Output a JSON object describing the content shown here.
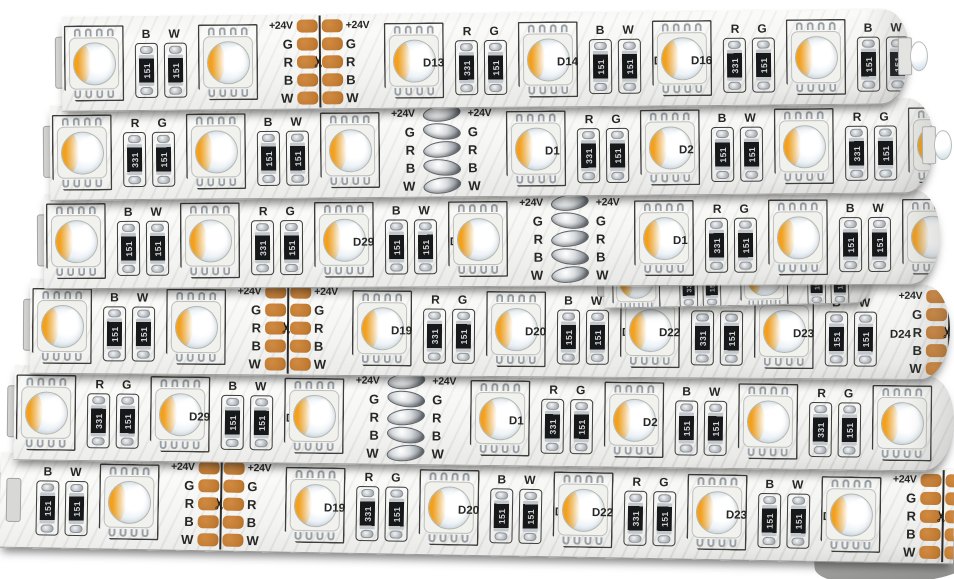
{
  "image_type": "product-photo",
  "subject": "Coiled 24V RGBW SMD LED strip light",
  "colors": {
    "background": "#ffffff",
    "strip_body": "#efefed",
    "copper_pad": "#c07a32",
    "silkscreen": "#2e2e2c",
    "led_warm": "#f3a01c",
    "led_cool": "#d3dfe9",
    "resistor_body": "#17181a",
    "solder": "#9ba1a7"
  },
  "labels": {
    "voltage": "+24V",
    "channels": [
      "G",
      "R",
      "B",
      "W"
    ],
    "scissors": "✂",
    "resistor_codes": [
      "331",
      "151"
    ]
  },
  "strips": [
    {
      "top": 12,
      "left": 62,
      "width": 848,
      "h": 96,
      "rot": -0.5,
      "z": 60,
      "rcap": true,
      "eled": true,
      "cells": [
        {
          "t": "led"
        },
        {
          "t": "res",
          "l": [
            "B",
            "W"
          ],
          "c": [
            "151",
            "151"
          ]
        },
        {
          "t": "led"
        },
        {
          "t": "cut",
          "s": "c"
        },
        {
          "t": "led"
        },
        {
          "t": "res",
          "l": [
            "R",
            "G"
          ],
          "c": [
            "331",
            "151"
          ],
          "dl": "D13"
        },
        {
          "t": "led"
        },
        {
          "t": "res",
          "l": [
            "B",
            "W"
          ],
          "c": [
            "151",
            "151"
          ],
          "dl": "D14",
          "dr": "D15"
        },
        {
          "t": "led"
        },
        {
          "t": "res",
          "l": [
            "R",
            "G"
          ],
          "c": [
            "331",
            "151"
          ],
          "dl": "D16"
        },
        {
          "t": "led"
        },
        {
          "t": "res",
          "l": [
            "B",
            "W"
          ],
          "c": [
            "151",
            "151"
          ]
        },
        {
          "t": "led"
        }
      ]
    },
    {
      "top": 101,
      "left": 50,
      "width": 884,
      "h": 96,
      "rot": -0.5,
      "z": 56,
      "rcap": true,
      "eled": true,
      "cells": [
        {
          "t": "led"
        },
        {
          "t": "res",
          "l": [
            "R",
            "G"
          ],
          "c": [
            "331",
            "151"
          ]
        },
        {
          "t": "led"
        },
        {
          "t": "res",
          "l": [
            "B",
            "W"
          ],
          "c": [
            "151",
            "151"
          ]
        },
        {
          "t": "led"
        },
        {
          "t": "cut",
          "s": "s"
        },
        {
          "t": "led"
        },
        {
          "t": "res",
          "l": [
            "R",
            "G"
          ],
          "c": [
            "331",
            "151"
          ],
          "dl": "D1"
        },
        {
          "t": "led"
        },
        {
          "t": "res",
          "l": [
            "B",
            "W"
          ],
          "c": [
            "151",
            "151"
          ],
          "dl": "D2",
          "dr": "D3"
        },
        {
          "t": "led"
        },
        {
          "t": "res",
          "l": [
            "R",
            "G"
          ],
          "c": [
            "331",
            "151"
          ]
        },
        {
          "t": "led"
        }
      ]
    },
    {
      "top": 191,
      "left": 44,
      "width": 896,
      "h": 96,
      "rot": -0.3,
      "z": 52,
      "rcap": true,
      "eled": false,
      "cells": [
        {
          "t": "led"
        },
        {
          "t": "res",
          "l": [
            "B",
            "W"
          ],
          "c": [
            "151",
            "151"
          ]
        },
        {
          "t": "led"
        },
        {
          "t": "res",
          "l": [
            "R",
            "G"
          ],
          "c": [
            "331",
            "151"
          ]
        },
        {
          "t": "led"
        },
        {
          "t": "res",
          "l": [
            "B",
            "W"
          ],
          "c": [
            "151",
            "151"
          ],
          "dl": "D29",
          "dr": "D30"
        },
        {
          "t": "led"
        },
        {
          "t": "cut",
          "s": "s"
        },
        {
          "t": "led"
        },
        {
          "t": "res",
          "l": [
            "R",
            "G"
          ],
          "c": [
            "331",
            "151"
          ],
          "dl": "D1"
        },
        {
          "t": "led"
        },
        {
          "t": "res",
          "l": [
            "B",
            "W"
          ],
          "c": [
            "151",
            "151"
          ]
        },
        {
          "t": "led"
        }
      ]
    },
    {
      "top": 252,
      "left": 604,
      "width": 268,
      "h": 54,
      "rot": -1.2,
      "z": 46,
      "rcap": true,
      "eled": false,
      "partial": true,
      "cells": [
        {
          "t": "led"
        },
        {
          "t": "res",
          "l": [
            "",
            ""
          ],
          "c": [
            "331",
            "151"
          ],
          "dl": "D13"
        },
        {
          "t": "led"
        },
        {
          "t": "res",
          "l": [
            "",
            ""
          ],
          "c": [
            "151",
            "151"
          ]
        }
      ]
    },
    {
      "top": 281,
      "left": 30,
      "width": 920,
      "h": 96,
      "rot": 0.4,
      "z": 44,
      "rcap": true,
      "eled": false,
      "cells": [
        {
          "t": "led"
        },
        {
          "t": "res",
          "l": [
            "B",
            "W"
          ],
          "c": [
            "151",
            "151"
          ]
        },
        {
          "t": "led"
        },
        {
          "t": "cut",
          "s": "c"
        },
        {
          "t": "led"
        },
        {
          "t": "res",
          "l": [
            "R",
            "G"
          ],
          "c": [
            "331",
            "151"
          ],
          "dl": "D19"
        },
        {
          "t": "led"
        },
        {
          "t": "res",
          "l": [
            "B",
            "W"
          ],
          "c": [
            "151",
            "151"
          ],
          "dl": "D20",
          "dr": "D21"
        },
        {
          "t": "led"
        },
        {
          "t": "res",
          "l": [
            "R",
            "G"
          ],
          "c": [
            "331",
            "151"
          ],
          "dl": "D22"
        },
        {
          "t": "led"
        },
        {
          "t": "res",
          "l": [
            "B",
            "W"
          ],
          "c": [
            "151",
            "151"
          ],
          "dl": "D23",
          "dr": "D24"
        },
        {
          "t": "cut",
          "s": "c"
        }
      ]
    },
    {
      "top": 370,
      "left": 14,
      "width": 940,
      "h": 96,
      "rot": 0.7,
      "z": 40,
      "rcap": true,
      "eled": false,
      "cells": [
        {
          "t": "led"
        },
        {
          "t": "res",
          "l": [
            "R",
            "G"
          ],
          "c": [
            "331",
            "151"
          ]
        },
        {
          "t": "led"
        },
        {
          "t": "res",
          "l": [
            "B",
            "W"
          ],
          "c": [
            "151",
            "151"
          ],
          "dl": "D29",
          "dr": "D30"
        },
        {
          "t": "led"
        },
        {
          "t": "cut",
          "s": "s"
        },
        {
          "t": "led"
        },
        {
          "t": "res",
          "l": [
            "R",
            "G"
          ],
          "c": [
            "331",
            "151"
          ],
          "dl": "D1"
        },
        {
          "t": "led"
        },
        {
          "t": "res",
          "l": [
            "B",
            "W"
          ],
          "c": [
            "151",
            "151"
          ],
          "dl": "D2",
          "dr": "D3"
        },
        {
          "t": "led"
        },
        {
          "t": "res",
          "l": [
            "R",
            "G"
          ],
          "c": [
            "331",
            "151"
          ]
        },
        {
          "t": "led"
        }
      ]
    },
    {
      "top": 460,
      "left": 0,
      "width": 954,
      "h": 96,
      "rot": 1.0,
      "z": 36,
      "rcap": false,
      "eled": false,
      "cells": [
        {
          "t": "tab"
        },
        {
          "t": "res",
          "l": [
            "B",
            "W"
          ],
          "c": [
            "151",
            "151"
          ]
        },
        {
          "t": "led"
        },
        {
          "t": "cut",
          "s": "c"
        },
        {
          "t": "led"
        },
        {
          "t": "res",
          "l": [
            "R",
            "G"
          ],
          "c": [
            "331",
            "151"
          ],
          "dl": "D19"
        },
        {
          "t": "led"
        },
        {
          "t": "res",
          "l": [
            "B",
            "W"
          ],
          "c": [
            "151",
            "151"
          ],
          "dl": "D20",
          "dr": "D21"
        },
        {
          "t": "led"
        },
        {
          "t": "res",
          "l": [
            "R",
            "G"
          ],
          "c": [
            "331",
            "151"
          ],
          "dl": "D22"
        },
        {
          "t": "led"
        },
        {
          "t": "res",
          "l": [
            "B",
            "W"
          ],
          "c": [
            "151",
            "151"
          ],
          "dl": "D23",
          "dr": "D24"
        },
        {
          "t": "led"
        },
        {
          "t": "cut",
          "s": "c"
        },
        {
          "t": "led"
        },
        {
          "t": "res",
          "l": [
            "R",
            "G"
          ],
          "c": [
            "331",
            "151"
          ]
        },
        {
          "t": "led"
        }
      ]
    }
  ]
}
